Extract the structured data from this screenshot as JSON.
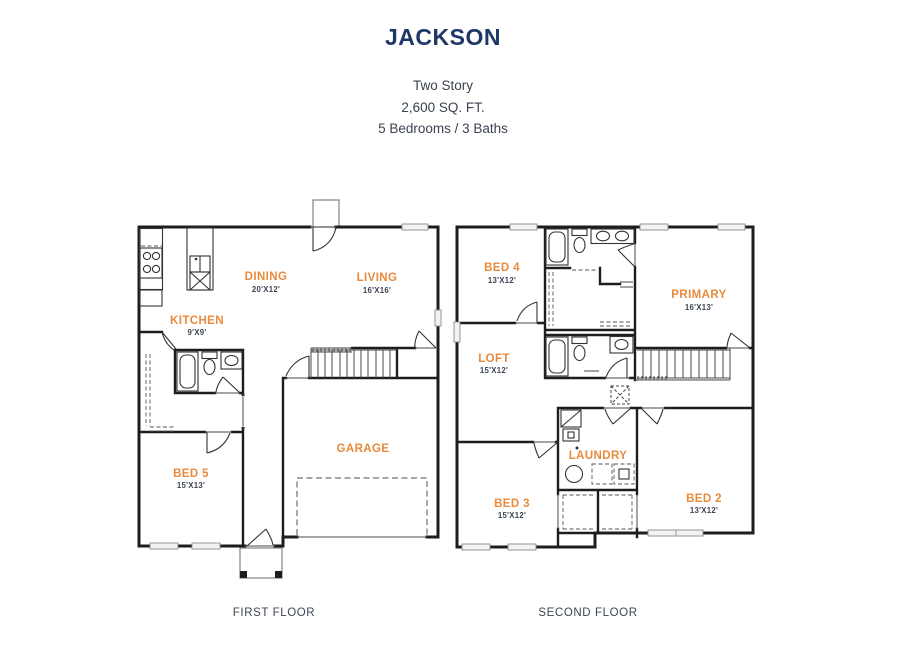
{
  "header": {
    "title": "JACKSON",
    "line1": "Two Story",
    "line2": "2,600 SQ. FT.",
    "line3": "5 Bedrooms / 3 Baths"
  },
  "floors": {
    "first": {
      "caption": "FIRST FLOOR",
      "rooms": {
        "kitchen": {
          "name": "KITCHEN",
          "dims": "9'X9'"
        },
        "dining": {
          "name": "DINING",
          "dims": "20'X12'"
        },
        "living": {
          "name": "LIVING",
          "dims": "16'X16'"
        },
        "bed5": {
          "name": "BED 5",
          "dims": "15'X13'"
        },
        "garage": {
          "name": "GARAGE"
        }
      }
    },
    "second": {
      "caption": "SECOND FLOOR",
      "rooms": {
        "bed4": {
          "name": "BED 4",
          "dims": "13'X12'"
        },
        "primary": {
          "name": "PRIMARY",
          "dims": "16'X13'"
        },
        "loft": {
          "name": "LOFT",
          "dims": "15'X12'"
        },
        "laundry": {
          "name": "LAUNDRY"
        },
        "bed3": {
          "name": "BED 3",
          "dims": "15'X12'"
        },
        "bed2": {
          "name": "BED 2",
          "dims": "13'X12'"
        }
      }
    }
  },
  "colors": {
    "title_navy": "#1e3766",
    "room_label_orange": "#e98a3c",
    "dimension_text": "#3c4352",
    "wall": "#1d1d1d",
    "background": "#ffffff"
  }
}
